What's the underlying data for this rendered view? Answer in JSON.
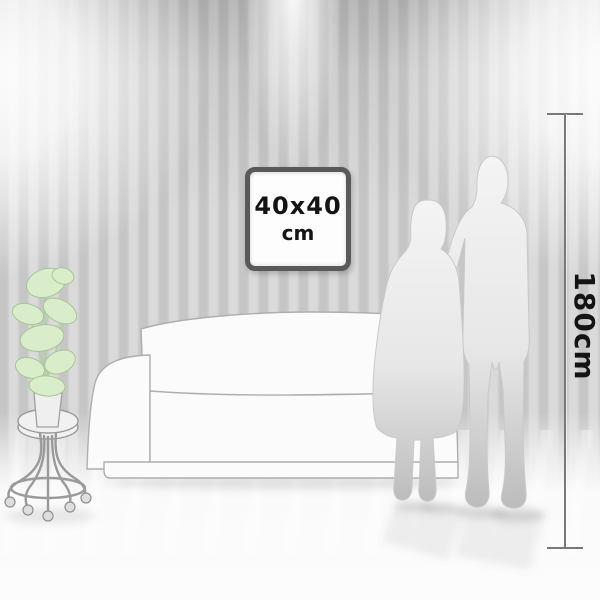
{
  "artwork": {
    "size_label": "40x40",
    "size_unit": "cm"
  },
  "ruler": {
    "height_label": "180cm"
  },
  "colors": {
    "wall_stripe_dark": "#c6c6c6",
    "wall_stripe_light": "#dadada",
    "floor_light": "#fafafa",
    "frame_border": "#595959",
    "frame_face": "#fdfdfd",
    "label_text": "#141414",
    "ruler_line": "#787878",
    "plant_leaf": "#d9edca",
    "plant_leaf_edge": "#a6c596",
    "silhouette_top": "#f4f4f4",
    "silhouette_bottom": "#bcbcbc",
    "silhouette_outline": "#c9c9c9",
    "sofa_fill": "#fbfbfb",
    "sofa_outline": "#aeaeae",
    "stool_stroke": "#9a9a9a"
  }
}
